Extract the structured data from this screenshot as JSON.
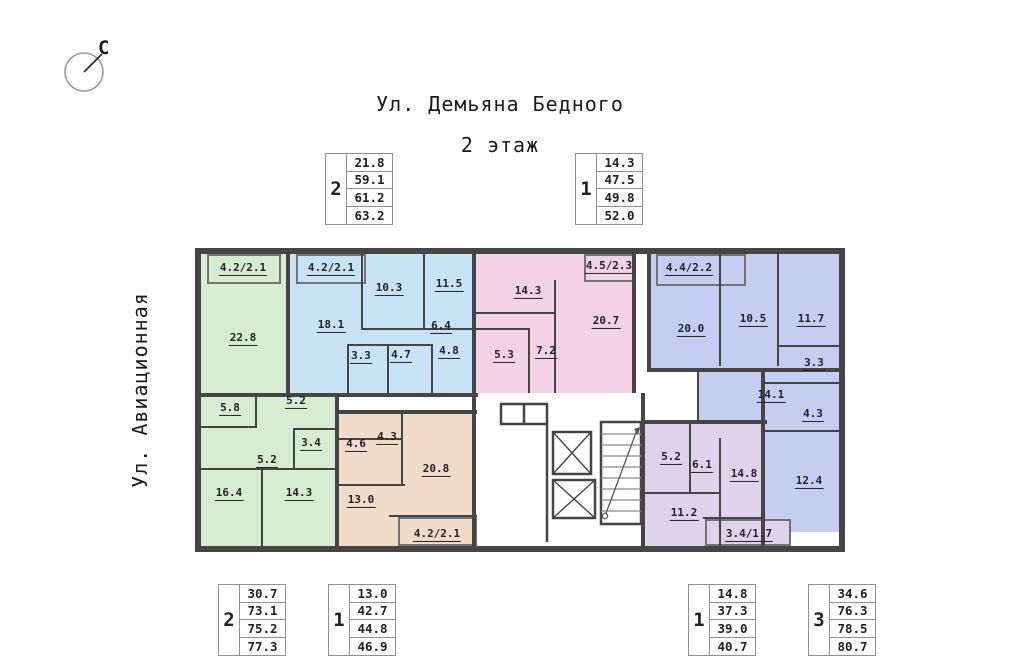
{
  "title": {
    "street_top": "Ул. Демьяна Бедного",
    "floor": "2 этаж",
    "street_left": "Ул. Авиационная",
    "compass": "С"
  },
  "summary_boxes": {
    "top": [
      {
        "rooms": "2",
        "areas": [
          "21.8",
          "59.1",
          "61.2",
          "63.2"
        ],
        "x": 325,
        "y": 153
      },
      {
        "rooms": "1",
        "areas": [
          "14.3",
          "47.5",
          "49.8",
          "52.0"
        ],
        "x": 575,
        "y": 153
      }
    ],
    "bottom": [
      {
        "rooms": "2",
        "areas": [
          "30.7",
          "73.1",
          "75.2",
          "77.3"
        ],
        "x": 218,
        "y": 584
      },
      {
        "rooms": "1",
        "areas": [
          "13.0",
          "42.7",
          "44.8",
          "46.9"
        ],
        "x": 328,
        "y": 584
      },
      {
        "rooms": "1",
        "areas": [
          "14.8",
          "37.3",
          "39.0",
          "40.7"
        ],
        "x": 688,
        "y": 584
      },
      {
        "rooms": "3",
        "areas": [
          "34.6",
          "76.3",
          "78.5",
          "80.7"
        ],
        "x": 808,
        "y": 584
      }
    ]
  },
  "plan": {
    "wall_color": "#454545",
    "apartments": [
      {
        "id": "green-2room",
        "color": "#d8ecd2",
        "regions": [
          [
            0,
            0,
            85,
            139
          ],
          [
            0,
            139,
            136,
            153
          ]
        ],
        "balconies": [
          [
            6,
            0,
            74,
            30
          ]
        ],
        "rooms": [
          {
            "a": "4.2/2.1",
            "x": 42,
            "y": 15
          },
          {
            "a": "22.8",
            "x": 42,
            "y": 85
          },
          {
            "a": "5.8",
            "x": 29,
            "y": 155
          },
          {
            "a": "5.2",
            "x": 95,
            "y": 148
          },
          {
            "a": "3.4",
            "x": 110,
            "y": 190
          },
          {
            "a": "5.2",
            "x": 66,
            "y": 207
          },
          {
            "a": "16.4",
            "x": 28,
            "y": 240
          },
          {
            "a": "14.3",
            "x": 98,
            "y": 240
          }
        ]
      },
      {
        "id": "blue-2room",
        "color": "#c9e3f6",
        "regions": [
          [
            85,
            0,
            190,
            139
          ]
        ],
        "balconies": [
          [
            95,
            0,
            70,
            30
          ]
        ],
        "rooms": [
          {
            "a": "4.2/2.1",
            "x": 130,
            "y": 15
          },
          {
            "a": "18.1",
            "x": 130,
            "y": 72
          },
          {
            "a": "10.3",
            "x": 188,
            "y": 35
          },
          {
            "a": "11.5",
            "x": 248,
            "y": 31
          },
          {
            "a": "6.4",
            "x": 240,
            "y": 73
          },
          {
            "a": "3.3",
            "x": 160,
            "y": 103
          },
          {
            "a": "4.7",
            "x": 200,
            "y": 102
          },
          {
            "a": "4.8",
            "x": 248,
            "y": 98
          }
        ]
      },
      {
        "id": "pink-1room",
        "color": "#f3d3e3",
        "regions": [
          [
            275,
            0,
            160,
            139
          ]
        ],
        "balconies": [
          [
            383,
            0,
            52,
            28
          ]
        ],
        "rooms": [
          {
            "a": "14.3",
            "x": 327,
            "y": 38
          },
          {
            "a": "4.5/2.3",
            "x": 408,
            "y": 13
          },
          {
            "a": "20.7",
            "x": 405,
            "y": 68
          },
          {
            "a": "7.2",
            "x": 345,
            "y": 98
          },
          {
            "a": "5.3",
            "x": 303,
            "y": 102
          }
        ]
      },
      {
        "id": "periwinkle-3room",
        "color": "#c5cef2",
        "regions": [
          [
            450,
            0,
            188,
            114
          ],
          [
            498,
            114,
            140,
            56
          ],
          [
            562,
            114,
            76,
            164
          ]
        ],
        "balconies": [
          [
            455,
            0,
            90,
            32
          ]
        ],
        "rooms": [
          {
            "a": "4.4/2.2",
            "x": 488,
            "y": 15
          },
          {
            "a": "20.0",
            "x": 490,
            "y": 76
          },
          {
            "a": "10.5",
            "x": 552,
            "y": 66
          },
          {
            "a": "11.7",
            "x": 610,
            "y": 66
          },
          {
            "a": "3.3",
            "x": 613,
            "y": 110
          },
          {
            "a": "14.1",
            "x": 570,
            "y": 142
          },
          {
            "a": "4.3",
            "x": 612,
            "y": 161
          },
          {
            "a": "12.4",
            "x": 608,
            "y": 228
          }
        ]
      },
      {
        "id": "tan-1room",
        "color": "#f1dbc9",
        "regions": [
          [
            134,
            160,
            141,
            132
          ]
        ],
        "balconies": [
          [
            197,
            263,
            79,
            29
          ]
        ],
        "rooms": [
          {
            "a": "4.6",
            "x": 155,
            "y": 191
          },
          {
            "a": "4.3",
            "x": 186,
            "y": 184
          },
          {
            "a": "20.8",
            "x": 235,
            "y": 216
          },
          {
            "a": "13.0",
            "x": 160,
            "y": 247
          },
          {
            "a": "4.2/2.1",
            "x": 236,
            "y": 281
          }
        ]
      },
      {
        "id": "purple-1room",
        "color": "#ded3ea",
        "regions": [
          [
            444,
            170,
            120,
            122
          ]
        ],
        "balconies": [
          [
            504,
            265,
            86,
            27
          ]
        ],
        "rooms": [
          {
            "a": "5.2",
            "x": 470,
            "y": 204
          },
          {
            "a": "6.1",
            "x": 501,
            "y": 212
          },
          {
            "a": "14.8",
            "x": 543,
            "y": 221
          },
          {
            "a": "11.2",
            "x": 483,
            "y": 260
          },
          {
            "a": "3.4/1.7",
            "x": 548,
            "y": 281
          }
        ]
      }
    ]
  }
}
